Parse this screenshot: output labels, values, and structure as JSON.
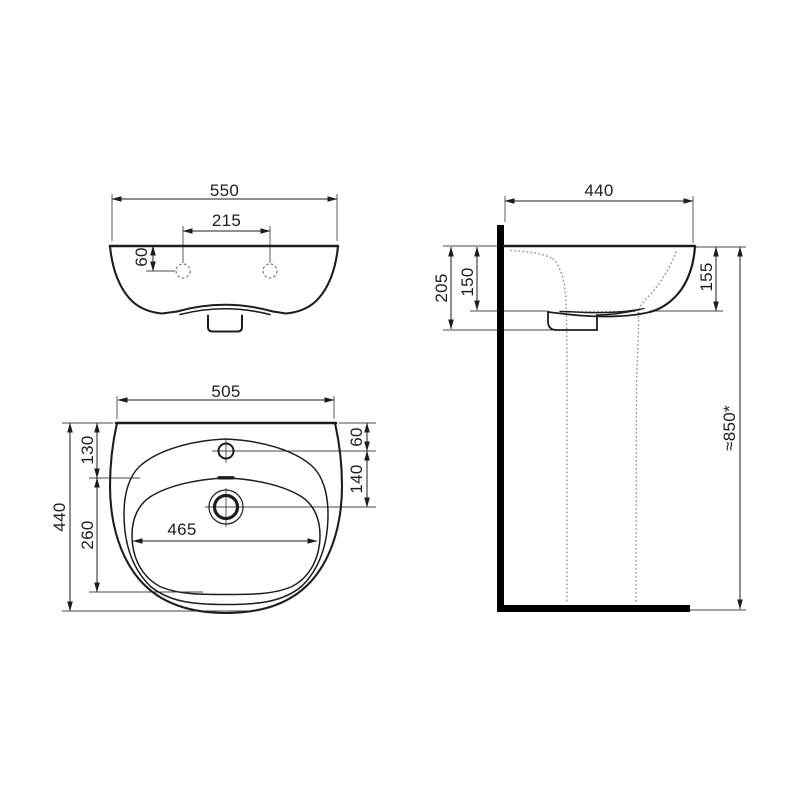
{
  "page": {
    "background": "#ffffff"
  },
  "drawing": {
    "colors": {
      "line": "#1d1d1d",
      "heavy": "#000000",
      "hidden": "#9b9b9b",
      "background": "#ffffff"
    },
    "front_view": {
      "overall_width": "550",
      "tap_hole_spacing": "215",
      "tap_hole_drop": "60"
    },
    "side_view": {
      "overall_depth": "440",
      "wall_to_trap": "205",
      "bowl_inner_depth": "150",
      "front_apron_height": "155",
      "mounting_height": "≈850*"
    },
    "plan_view": {
      "basin_width": "505",
      "basin_depth": "440",
      "rim_to_bowl": "130",
      "bowl_length": "260",
      "bowl_width": "465",
      "rim_to_tap": "60",
      "tap_to_drain": "140"
    }
  }
}
